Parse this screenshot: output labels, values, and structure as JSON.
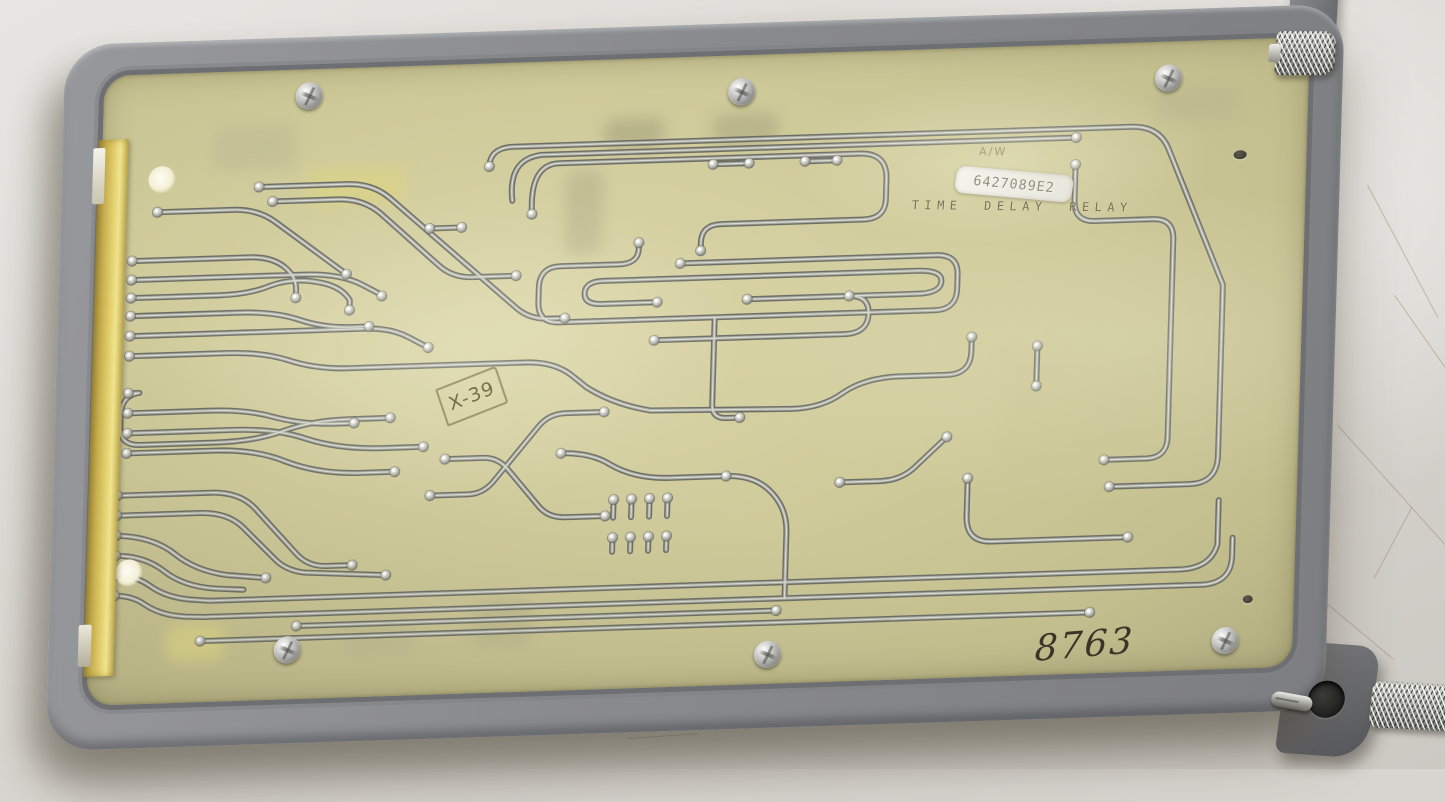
{
  "scene": {
    "type": "photograph",
    "description": "Vintage TIME DELAY RELAY printed circuit board module, solder side up, mounted in a gray metal carrier frame with knurled thumb screws, lying on a scratched light-gray table surface",
    "surface_color": "#d9d6d1"
  },
  "module": {
    "frame_color": "#8a8b8f",
    "pcb_color": "#cfca9a",
    "edge_connector_color": "#d7c361",
    "trace_color": "#8f9088",
    "solder_pad_color": "#c9cac2",
    "markings": {
      "faint_marking": "A/W",
      "part_label": "6427089E2",
      "stamp_title": "TIME DELAY RELAY",
      "inspection_stamp": "X-39",
      "handwritten_number": "8763"
    }
  },
  "drawing": {
    "traces": [
      "M 33,186 L 150,186 Q 173,186 186,197 Q 198,207 198,220 L 198,226",
      "M 33,205 L 205,205 Q 242,205 264,217 L 284,228",
      "M 33,223 L 120,223 Q 152,223 172,215 Q 196,207 224,214 Q 244,219 252,232 L 252,240",
      "M 33,241 L 142,241 Q 177,241 202,250 Q 227,259 254,259 L 272,259",
      "M 33,261 L 268,261 Q 294,261 312,271 L 332,282",
      "M 33,281 L 130,281 Q 166,281 192,290 Q 220,300 252,300 L 430,300 Q 458,300 476,314 L 492,327",
      "M 33,318 L 44,318 Q 26,320 26,340 L 26,352 Q 26,370 46,370 L 120,370 Q 162,370 188,361 Q 218,351 254,351 L 296,351",
      "M 33,338 L 115,338 Q 152,338 178,346 Q 208,355 242,355 L 260,355",
      "M 33,358 L 140,358 Q 182,358 212,369 Q 246,381 290,381 L 330,381",
      "M 33,378 L 120,378 Q 162,378 192,391 Q 226,405 268,405 L 300,405",
      "M 25,420 L 118,420 Q 148,420 164,438 L 206,484 Q 218,497 236,497 L 262,497",
      "M 25,440 L 108,440 Q 136,440 152,456 L 186,490 Q 198,501 216,503 L 296,508",
      "M 25,460 Q 62,462 84,480 Q 106,498 138,503 L 176,507",
      "M 25,480 Q 54,481 74,497 Q 94,513 126,516 L 154,518",
      "M 25,500 Q 45,500 60,511 Q 76,523 100,526 L 120,528",
      "M 25,520 Q 42,520 56,530 Q 72,541 96,543 L 114,544",
      "M 120,528 L 1090,528 Q 1122,528 1128,504 L 1128,460",
      "M 114,544 L 1112,544 Q 1143,544 1143,516 L 1143,498",
      "M 112,568 L 1002,568",
      "M 208,556 L 688,556",
      "M 57,138 L 132,138 Q 158,138 176,152 L 248,206",
      "M 172,131 L 238,131 Q 262,131 280,146 L 340,200 Q 354,213 374,213 L 418,213",
      "M 158,116 L 246,116 Q 272,116 290,132 L 420,246 Q 433,257 452,257 L 468,257",
      "M 388,103 Q 388,84 412,84 L 1030,84 Q 1058,84 1068,108 L 1126,245 L 1126,415 Q 1126,443 1098,443 L 1018,443",
      "M 412,138 Q 406,96 440,93 L 975,93",
      "M 432,152 Q 428,102 458,102 L 758,102 Q 786,102 786,128 L 786,148 Q 786,168 764,168 L 622,168 Q 602,168 602,186 L 602,193",
      "M 975,120 L 975,156 Q 975,177 996,177 L 1054,177 Q 1075,177 1075,198 L 1075,395 Q 1075,416 1054,416 L 1012,416",
      "M 540,184 L 540,190 Q 540,205 520,205 L 462,205 Q 441,205 441,226 L 441,240 Q 441,261 462,261 L 838,261 Q 860,261 860,240 L 860,226 Q 860,206 838,206 L 582,206",
      "M 560,244 L 504,244 Q 487,244 487,233 Q 487,221 505,221 L 820,221 Q 844,221 844,232 Q 844,244 820,244 L 650,244",
      "M 558,282 L 748,282 Q 772,282 772,262 Q 772,244 752,244",
      "M 618,261 L 618,348 Q 618,362 632,362 L 646,362",
      "M 492,327 Q 520,345 556,352 L 698,355 Q 728,355 748,341 Q 770,326 806,326 L 852,326 Q 876,326 876,303 L 876,291",
      "M 468,392 Q 498,392 518,405 Q 543,420 578,420 L 634,420",
      "M 942,340 L 942,302",
      "M 338,430 L 376,430 Q 391,430 401,418 L 445,364 Q 455,352 472,352 L 510,352",
      "M 352,394 L 390,394 Q 405,394 415,406 L 447,444 Q 457,456 474,456 L 514,456",
      "M 522,440 L 522,458",
      "M 540,440 L 540,458",
      "M 558,440 L 558,458",
      "M 576,440 L 576,458",
      "M 522,478 L 522,492",
      "M 540,478 L 540,492",
      "M 558,478 L 558,492",
      "M 576,478 L 576,492",
      "M 634,420 Q 660,420 676,434 Q 696,452 696,478 L 696,544",
      "M 876,430 L 876,468 Q 876,494 902,494 L 1038,494",
      "M 748,430 L 788,430 Q 810,430 824,416 L 854,388",
      "M 612,108 L 648,108",
      "M 704,108 L 736,108",
      "M 330,163 L 362,163"
    ],
    "pads": [
      [
        33,
        186
      ],
      [
        33,
        205
      ],
      [
        33,
        223
      ],
      [
        33,
        241
      ],
      [
        33,
        261
      ],
      [
        33,
        281
      ],
      [
        33,
        318
      ],
      [
        33,
        338
      ],
      [
        33,
        358
      ],
      [
        33,
        378
      ],
      [
        25,
        420
      ],
      [
        25,
        440
      ],
      [
        25,
        460
      ],
      [
        25,
        480
      ],
      [
        25,
        500
      ],
      [
        25,
        520
      ],
      [
        198,
        228
      ],
      [
        284,
        229
      ],
      [
        252,
        242
      ],
      [
        272,
        259
      ],
      [
        332,
        282
      ],
      [
        296,
        351
      ],
      [
        260,
        355
      ],
      [
        330,
        381
      ],
      [
        302,
        405
      ],
      [
        262,
        497
      ],
      [
        296,
        508
      ],
      [
        176,
        507
      ],
      [
        112,
        568
      ],
      [
        1002,
        568
      ],
      [
        208,
        556
      ],
      [
        688,
        556
      ],
      [
        57,
        138
      ],
      [
        248,
        206
      ],
      [
        172,
        131
      ],
      [
        418,
        213
      ],
      [
        158,
        116
      ],
      [
        468,
        257
      ],
      [
        388,
        103
      ],
      [
        1018,
        443
      ],
      [
        975,
        93
      ],
      [
        602,
        194
      ],
      [
        432,
        152
      ],
      [
        975,
        120
      ],
      [
        1012,
        416
      ],
      [
        540,
        184
      ],
      [
        582,
        206
      ],
      [
        560,
        244
      ],
      [
        650,
        244
      ],
      [
        558,
        282
      ],
      [
        752,
        244
      ],
      [
        646,
        362
      ],
      [
        876,
        289
      ],
      [
        468,
        392
      ],
      [
        634,
        420
      ],
      [
        942,
        340
      ],
      [
        942,
        300
      ],
      [
        338,
        430
      ],
      [
        510,
        352
      ],
      [
        352,
        394
      ],
      [
        514,
        456
      ],
      [
        522,
        440
      ],
      [
        540,
        440
      ],
      [
        558,
        440
      ],
      [
        576,
        440
      ],
      [
        522,
        478
      ],
      [
        540,
        478
      ],
      [
        558,
        478
      ],
      [
        576,
        478
      ],
      [
        876,
        430
      ],
      [
        1038,
        494
      ],
      [
        748,
        430
      ],
      [
        854,
        388
      ],
      [
        612,
        108
      ],
      [
        648,
        108
      ],
      [
        704,
        108
      ],
      [
        736,
        108
      ],
      [
        330,
        163
      ],
      [
        362,
        163
      ]
    ],
    "screws": [
      [
        245,
        58
      ],
      [
        678,
        68
      ],
      [
        1105,
        68
      ],
      [
        239,
        611
      ],
      [
        720,
        631
      ],
      [
        1178,
        632
      ]
    ],
    "ghosts": [
      [
        205,
        100,
        100,
        36,
        "#ddd67b",
        0.5
      ],
      [
        502,
        60,
        60,
        30,
        "#8f8c6b",
        0.38
      ],
      [
        610,
        58,
        66,
        32,
        "#8f8c6b",
        0.33
      ],
      [
        465,
        110,
        38,
        84,
        "#9a9678",
        0.3
      ],
      [
        78,
        552,
        58,
        36,
        "#eae285",
        0.55
      ],
      [
        1055,
        50,
        80,
        28,
        "#b3af8f",
        0.35
      ],
      [
        385,
        536,
        58,
        46,
        "#a8a486",
        0.3
      ],
      [
        110,
        56,
        84,
        42,
        "#aeaa8b",
        0.3
      ],
      [
        255,
        556,
        72,
        32,
        "#b5b091",
        0.28
      ],
      [
        905,
        300,
        180,
        120,
        "#c5c08e",
        0.22
      ]
    ],
    "scratches": [
      [
        1368,
        185,
        150,
        62
      ],
      [
        1395,
        295,
        145,
        55
      ],
      [
        1338,
        425,
        185,
        48
      ],
      [
        1302,
        582,
        120,
        40
      ],
      [
        1412,
        508,
        80,
        118
      ],
      [
        235,
        730,
        95,
        6
      ],
      [
        628,
        738,
        70,
        -4
      ]
    ]
  }
}
